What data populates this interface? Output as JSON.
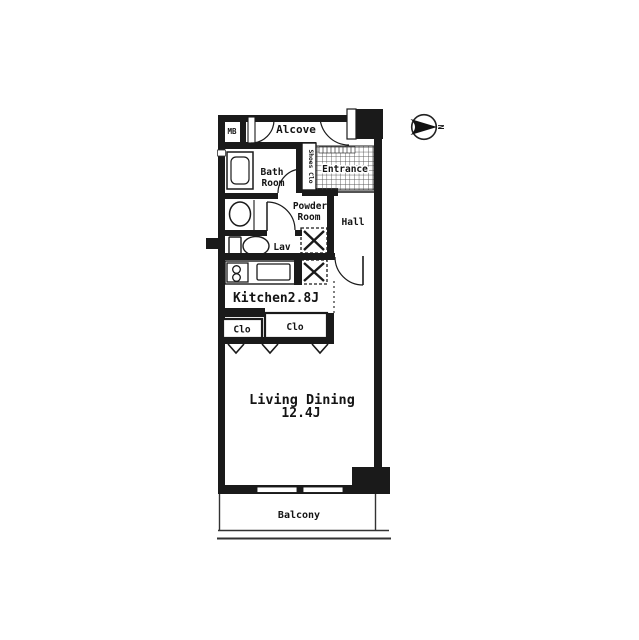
{
  "plan": {
    "type": "apartment-floorplan",
    "compass": {
      "label": "N",
      "direction": "right"
    },
    "rooms": {
      "mb": "MB",
      "alcove": "Alcove",
      "shoes_closet": "Shoes Clo",
      "entrance": "Entrance",
      "bath": {
        "line1": "Bath",
        "line2": "Room"
      },
      "powder": {
        "line1": "Powder",
        "line2": "Room"
      },
      "hall": "Hall",
      "lav": "Lav",
      "kitchen": {
        "label": "Kitchen2.8J",
        "size_jo": "2.8J"
      },
      "closet_left": "Clo",
      "closet_right": "Clo",
      "living": {
        "line1": "Living Dining",
        "line2": "12.4J",
        "size_jo": "12.4J"
      },
      "balcony": "Balcony"
    },
    "colors": {
      "wall": "#1a1a1a",
      "floor": "#ffffff",
      "hatch_line": "#555555"
    }
  }
}
